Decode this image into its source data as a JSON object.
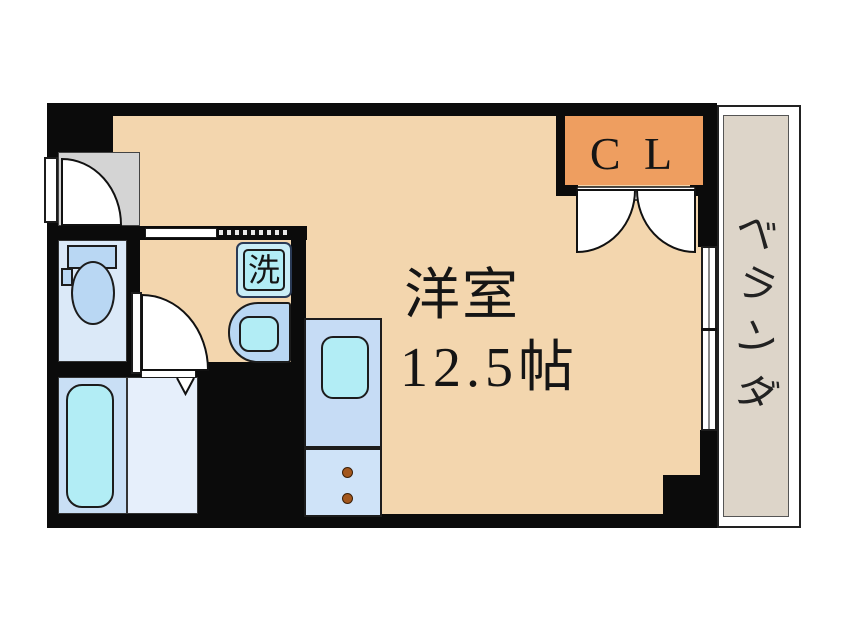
{
  "floorplan": {
    "main_room": {
      "name": "洋室",
      "area": "12.5帖"
    },
    "closet_label": "C L",
    "entrance_label": "玄",
    "laundry_label": "洗",
    "veranda_label": "ベランダ",
    "veranda_chars": [
      "ベ",
      "ラ",
      "ン",
      "ダ"
    ],
    "colors": {
      "wall": "#0b0b0b",
      "room": "#f3d6ae",
      "closet": "#ee9e60",
      "veranda": "#ddd5c9",
      "entrance": "#d4d4d4",
      "wetroom": "#dbe9f8",
      "fixture": "#b9d7f3",
      "cyan": "#b2edf5",
      "kitchen": "#c6dcf5",
      "kitchenlower": "#cfe3f8",
      "bathfloor": "#e6effb",
      "tubunit": "#c9dff5",
      "knob": "#a3571d",
      "laundrybox": "#c9edf6"
    }
  }
}
